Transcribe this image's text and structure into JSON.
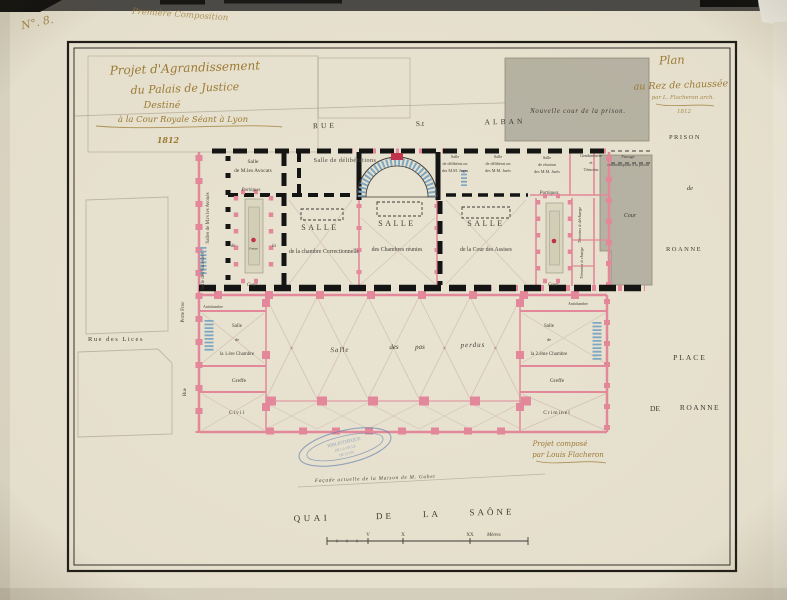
{
  "colors": {
    "paper": "#e9e3d1",
    "wall_pink": "#e4899b",
    "wall_red": "#c2334a",
    "wall_black": "#141414",
    "stair_blue": "#7fa9c4",
    "prison_gray": "#b8b4a5",
    "ink_gold": "#9d7c34",
    "ink_dark": "#3f3b32",
    "stamp_blue": "#5b79b0",
    "pencil": "#978e76"
  },
  "annotations": {
    "number": "N°. 8.",
    "composition": "Première Composition"
  },
  "title_block": {
    "line1": "Projet d'Agrandissement",
    "line2": "du Palais de Justice",
    "line3": "Destiné",
    "line4": "à la Cour Royale Séant à Lyon",
    "year": "1812"
  },
  "plan_title": {
    "line1": "Plan",
    "line2": "au Rez de chaussée",
    "line3": "par L. Flacheron arch.",
    "year": "1812"
  },
  "streets": {
    "rue1": "RUE",
    "rue2": "S.t",
    "rue3": "ALBAN",
    "quai1": "QUAI",
    "quai2": "DE",
    "quai3": "LA",
    "quai4": "SAÔNE",
    "place1": "PLACE",
    "place2": "DE",
    "place3": "ROANNE",
    "prison1": "PRISON",
    "prison2": "de",
    "prison3": "ROANNE",
    "rue_des_lices": "Rue des Lices",
    "porte_froc": "Porte Froc",
    "rue_left": "Rue"
  },
  "prison": {
    "nouvelle_cour": "Nouvelle cour de la prison.",
    "cour": "Cour",
    "passage1": "Passage",
    "passage2": "communiquant à la prison"
  },
  "rooms": {
    "avoues": "Salles de M.rs les Avoués",
    "huissiers": "Salle des Huissiers",
    "avocats1": "Salle",
    "avocats2": "de M.les Avocats",
    "deliberations": "Salle de délibérations",
    "salle1a": "SALLE",
    "salle1b": "de la chambre Correctionnelle",
    "salle2a": "SALLE",
    "salle2b": "des Chambres réunies",
    "salle3a": "SALLE",
    "salle3b": "de la Cour des Assises",
    "dj1": "Salle",
    "dj2": "de délibérat.on",
    "dj3": "des M.M. Juges",
    "dr1": "Salle",
    "dr2": "de délibérat.on",
    "dr3": "des M.M. Jurés",
    "rj1": "Salle",
    "rj2": "de réunion",
    "rj3": "des M.M. Jurés",
    "g1": "Gendarmerie",
    "g2": "et",
    "g3": "Témoins",
    "td": "Témoins à décharge",
    "tc": "Témoins à charge",
    "port_l": "Portiques",
    "port_r": "Portiques",
    "cour_l": "Cour",
    "cour_r": "Cour",
    "de": "de",
    "la": "la",
    "pompe": "Pompe",
    "anti_l": "Antichambre",
    "anti_r": "Antichambre",
    "c1a": "Salle",
    "c1b": "de",
    "c1c": "la 1.ère Chambre",
    "greffe_l": "Greffe",
    "civil": "Civil",
    "c2a": "Salle",
    "c2b": "de",
    "c2c": "la 2.ème Chambre",
    "greffe_r": "Greffe",
    "criminel": "Criminel"
  },
  "hall": {
    "w1": "Salle",
    "w2": "des",
    "w3": "pas",
    "w4": "perdus"
  },
  "notes": {
    "facade": "Façade actuelle de la Maison de M. Gabet",
    "sig1": "Projet composé",
    "sig2": "par Louis Flacheron"
  },
  "stamp": {
    "line1": "BIBLIOTHÈQUE",
    "line2": "DE LA VILLE",
    "line3": "DE LYON"
  },
  "scale": {
    "t1": "V",
    "t2": "X",
    "t3": "XX",
    "unit": "Mètres"
  }
}
